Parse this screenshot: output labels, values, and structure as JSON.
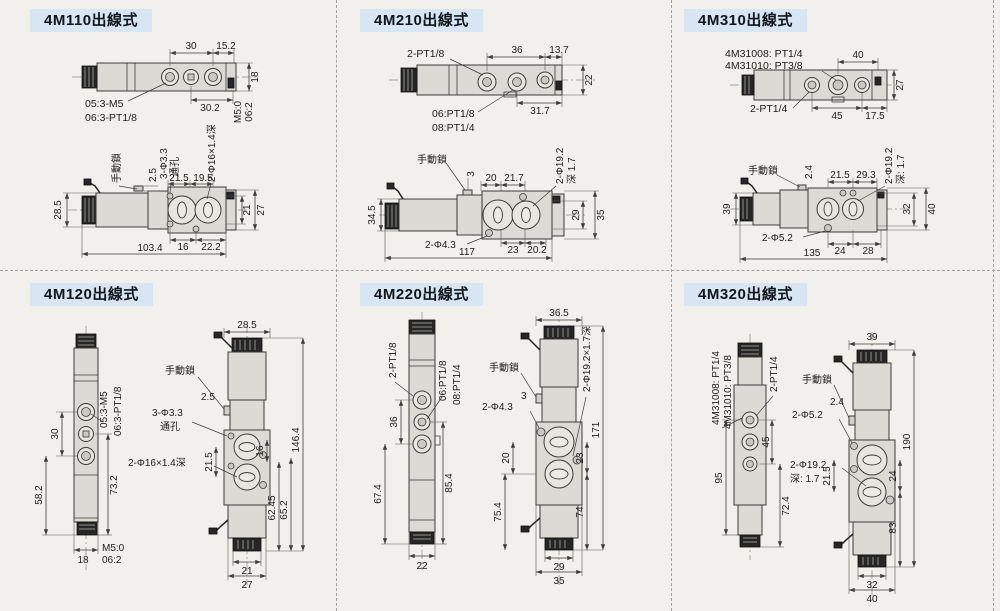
{
  "page": {
    "bg_color": "#f1f0ec",
    "badge_bg_color": "#d8e5f3",
    "badge_text_color": "#10151c"
  },
  "panels": {
    "p1": {
      "title": "4M110出線式",
      "top": {
        "pitch": "30",
        "end": "15.2",
        "height": "18",
        "span": "30.2",
        "rot1": "M5:0",
        "rot2": "06:2",
        "opt1": "05:3-M5",
        "opt2": "06:3-PT1/8"
      },
      "side": {
        "lock": "手動鎖",
        "d1": "2.5",
        "hole": "3-Φ3.3",
        "through": "通孔",
        "cbore": "2-Φ16×1.4深",
        "a1": "21.5",
        "a2": "19.5",
        "left": "28.5",
        "r1": "21",
        "r2": "27",
        "b1": "16",
        "b2": "22.2",
        "total": "103.4"
      }
    },
    "p2": {
      "title": "4M210出線式",
      "top": {
        "ports": "2-PT1/8",
        "pitch": "36",
        "end": "13.7",
        "height": "22",
        "span": "31.7",
        "opt1": "06:PT1/8",
        "opt2": "08:PT1/4"
      },
      "side": {
        "lock": "手動鎖",
        "d1": "3",
        "a1": "20",
        "a2": "21.7",
        "cbore": "2-Φ19.2",
        "depth": "深 1.7",
        "left": "34.5",
        "r1": "29",
        "r2": "35",
        "holes": "2-Φ4.3",
        "b1": "23",
        "b2": "20.2",
        "total": "117"
      }
    },
    "p3": {
      "title": "4M310出線式",
      "top": {
        "opt1": "4M31008: PT1/4",
        "opt2": "4M31010: PT3/8",
        "pitch": "40",
        "height": "27",
        "ports": "2-PT1/4",
        "b1": "45",
        "b2": "17.5"
      },
      "side": {
        "lock": "手動鎖",
        "d1": "2.4",
        "a1": "21.5",
        "a2": "29.3",
        "cbore": "2-Φ19.2",
        "depth": "深: 1.7",
        "left": "39",
        "r1": "32",
        "r2": "40",
        "holes": "2-Φ5.2",
        "b1": "24",
        "b2": "28",
        "total": "135"
      }
    },
    "p4": {
      "title": "4M120出線式",
      "front": {
        "opt1": "05:3-M5",
        "opt2": "06:3-PT1/8",
        "pitch": "30",
        "lower": "58.2",
        "right": "73.2",
        "width": "18",
        "rot1": "M5:0",
        "rot2": "06:2"
      },
      "side": {
        "width": "28.5",
        "lock": "手動鎖",
        "d1": "2.5",
        "hole": "3-Φ3.3",
        "through": "通孔",
        "d2": "21.5",
        "cbore": "2-Φ16×1.4深",
        "r1": "16",
        "r2": "62.45",
        "r3": "65.2",
        "total": "146.4",
        "b1": "21",
        "b2": "27"
      }
    },
    "p5": {
      "title": "4M220出線式",
      "front": {
        "ports": "2-PT1/8",
        "opt1": "06:PT1/8",
        "opt2": "08:PT1/4",
        "pitch": "36",
        "lower": "67.4",
        "right": "85.4",
        "width": "22"
      },
      "side": {
        "width": "36.5",
        "lock": "手動鎖",
        "d1": "3",
        "holes": "2-Φ4.3",
        "cbore": "2-Φ19.2×1.7深",
        "v1": "20",
        "v2": "23",
        "v3": "74",
        "total": "171",
        "lower": "75.4",
        "b1": "29",
        "b2": "35"
      }
    },
    "p6": {
      "title": "4M320出線式",
      "front": {
        "opt1": "4M31008: PT1/4",
        "opt2": "4M31010: PT3/8",
        "ports": "2-PT1/4",
        "v1": "45",
        "v2": "95",
        "v3": "72.4"
      },
      "side": {
        "width": "39",
        "lock": "手動鎖",
        "d1": "2.4",
        "holes": "2-Φ5.2",
        "v1": "21.5",
        "cbore": "2-Φ19.2",
        "depth": "深: 1.7",
        "r1": "24",
        "r2": "83",
        "total": "190",
        "b1": "32",
        "b2": "40"
      }
    }
  }
}
